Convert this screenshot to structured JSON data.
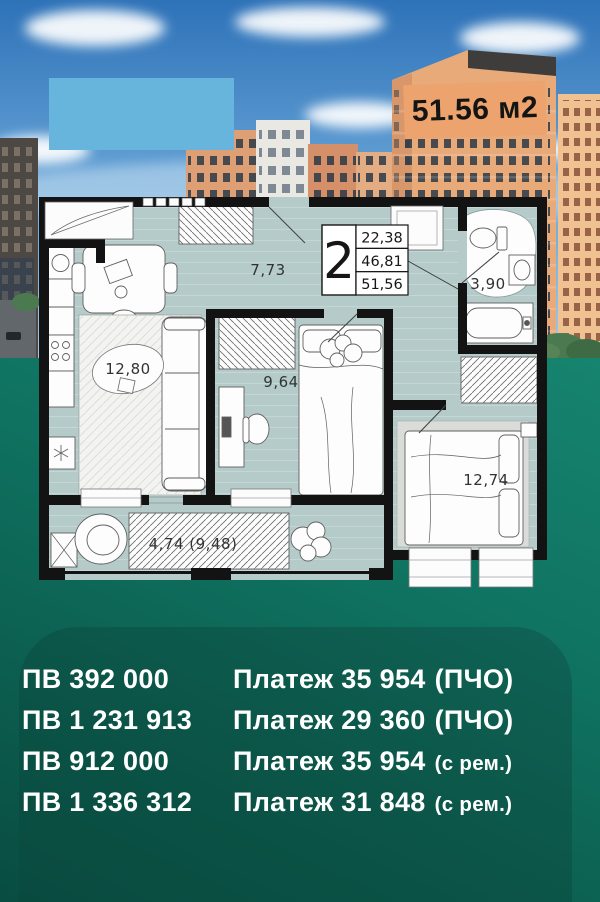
{
  "badge": {
    "area_label": "51.56 м2"
  },
  "floor_plan": {
    "stamp": {
      "rooms_count": "2",
      "living_area": "22,38",
      "area_no_balcony": "46,81",
      "total_area": "51,56"
    },
    "rooms": [
      {
        "name": "kitchen-living-room",
        "area": "12,80"
      },
      {
        "name": "hallway",
        "area": "7,73"
      },
      {
        "name": "bedroom",
        "area": "9,64"
      },
      {
        "name": "bathroom",
        "area": "3,90"
      },
      {
        "name": "bedroom-2",
        "area": "12,74"
      },
      {
        "name": "balcony",
        "area": "4,74 (9,48)"
      }
    ]
  },
  "offers": {
    "rows": [
      {
        "down_payment": "ПВ 392 000",
        "payment": "Платеж 35 954",
        "suffix": "(ПЧО)"
      },
      {
        "down_payment": "ПВ 1 231 913",
        "payment": "Платеж 29 360",
        "suffix": "(ПЧО)"
      },
      {
        "down_payment": "ПВ 912 000",
        "payment": "Платеж 35 954",
        "suffix": "(с рем.)"
      },
      {
        "down_payment": "ПВ 1 336 312",
        "payment": "Платеж 31 848",
        "suffix": "(с рем.)"
      }
    ]
  },
  "colors": {
    "accent_orange": "#eca36e",
    "background_teal": "#0e6d5c",
    "panel_green": "#0b5447",
    "logo_placeholder_blue": "#67b4dc",
    "plan_floor": "#b4cbca",
    "text_white": "#ffffff"
  }
}
